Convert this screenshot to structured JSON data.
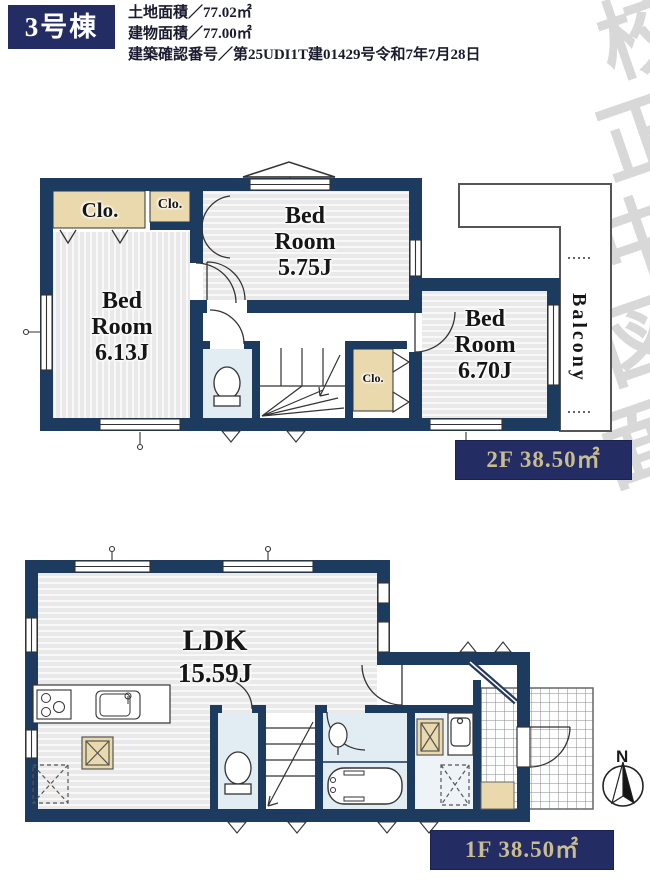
{
  "header": {
    "unit": "3号棟",
    "line1": "土地面積／77.02㎡",
    "line2": "建物面積／77.00㎡",
    "line3": "建築確認番号／第25UDI1T建01429号令和7年7月28日"
  },
  "watermark": [
    "校",
    "正",
    "中",
    "図",
    "面"
  ],
  "floor2": {
    "closet_left": "Clo.",
    "closet_small": "Clo.",
    "closet_hall": "Clo.",
    "bedroom_top": [
      "Bed",
      "Room",
      "5.75J"
    ],
    "bedroom_left": [
      "Bed",
      "Room",
      "6.13J"
    ],
    "bedroom_right": [
      "Bed",
      "Room",
      "6.70J"
    ],
    "balcony": "Balcony",
    "badge": "2F 38.50㎡"
  },
  "floor1": {
    "ldk": [
      "LDK",
      "15.59J"
    ],
    "badge": "1F 38.50㎡"
  },
  "compass": "N",
  "colors": {
    "wall_navy": "#1d3a5f",
    "badge_navy": "#232d63",
    "badge_text": "#c9bc8e",
    "closet_beige": "#ead9ad",
    "wet_floor_blue": "#e2ecf3"
  }
}
